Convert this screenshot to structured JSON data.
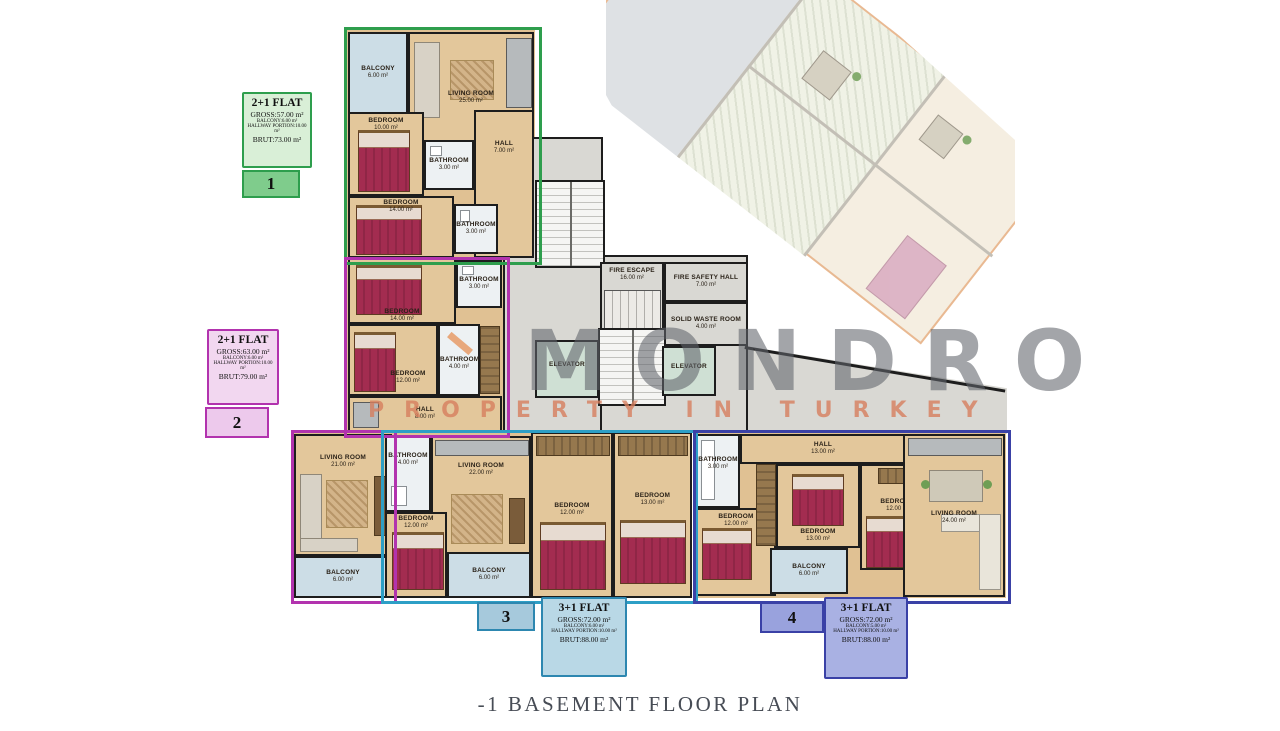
{
  "title": "-1 BASEMENT FLOOR PLAN",
  "watermark": {
    "line1": "MONDRO",
    "line2": "PROPERTY IN TURKEY"
  },
  "flats": [
    {
      "badge": "1",
      "name": "2+1 FLAT",
      "gross": "GROSS:57.00 m²",
      "balcony": "BALCONY:6.00 m²",
      "hallway": "HALLWAY PORTION:10.00 m²",
      "brut": "BRUT:73.00 m²",
      "color": "#2e9e4d"
    },
    {
      "badge": "2",
      "name": "2+1 FLAT",
      "gross": "GROSS:63.00 m²",
      "balcony": "BALCONY:6.00 m²",
      "hallway": "HALLWAY PORTION:10.00 m²",
      "brut": "BRUT:79.00 m²",
      "color": "#b233ae"
    },
    {
      "badge": "3",
      "name": "3+1 FLAT",
      "gross": "GROSS:72.00 m²",
      "balcony": "BALCONY:6.00 m²",
      "hallway": "HALLWAY PORTION:10.00 m²",
      "brut": "BRUT:88.00 m²",
      "color": "#2d87b0"
    },
    {
      "badge": "4",
      "name": "3+1 FLAT",
      "gross": "GROSS:72.00 m²",
      "balcony": "BALCONY:5.00 m²",
      "hallway": "HALLWAY PORTION:10.00 m²",
      "brut": "BRUT:88.00 m²",
      "color": "#3a41a6"
    }
  ],
  "rooms": [
    {
      "name": "BALCONY",
      "area": "6.00 m²"
    },
    {
      "name": "LIVING ROOM",
      "area": "25.00 m²"
    },
    {
      "name": "BEDROOM",
      "area": "10.00 m²"
    },
    {
      "name": "BATHROOM",
      "area": "3.00 m²"
    },
    {
      "name": "HALL",
      "area": "7.00 m²"
    },
    {
      "name": "BEDROOM",
      "area": "14.00 m²"
    },
    {
      "name": "BATHROOM",
      "area": "3.00 m²"
    },
    {
      "name": "BEDROOM",
      "area": "14.00 m²"
    },
    {
      "name": "BATHROOM",
      "area": "3.00 m²"
    },
    {
      "name": "BEDROOM",
      "area": "12.00 m²"
    },
    {
      "name": "BATHROOM",
      "area": "4.00 m²"
    },
    {
      "name": "HALL",
      "area": "8.00 m²"
    },
    {
      "name": "LIVING ROOM",
      "area": "21.00 m²"
    },
    {
      "name": "BALCONY",
      "area": "6.00 m²"
    },
    {
      "name": "BATHROOM",
      "area": "4.00 m²"
    },
    {
      "name": "LIVING ROOM",
      "area": "22.00 m²"
    },
    {
      "name": "BEDROOM",
      "area": "12.00 m²"
    },
    {
      "name": "BALCONY",
      "area": "6.00 m²"
    },
    {
      "name": "BEDROOM",
      "area": "12.00 m²"
    },
    {
      "name": "BEDROOM",
      "area": "13.00 m²"
    },
    {
      "name": "BATHROOM",
      "area": "3.00 m²"
    },
    {
      "name": "HALL",
      "area": "13.00 m²"
    },
    {
      "name": "BEDROOM",
      "area": "12.00 m²"
    },
    {
      "name": "BEDROOM",
      "area": "13.00 m²"
    },
    {
      "name": "BALCONY",
      "area": "6.00 m²"
    },
    {
      "name": "BEDROOM",
      "area": "12.00 m²"
    },
    {
      "name": "LIVING ROOM",
      "area": "24.00 m²"
    },
    {
      "name": "FIRE ESCAPE",
      "area": "16.00 m²"
    },
    {
      "name": "FIRE SAFETY HALL",
      "area": "7.00 m²"
    },
    {
      "name": "SOLID WASTE ROOM",
      "area": "4.00 m²"
    },
    {
      "name": "ELEVATOR",
      "area": ""
    },
    {
      "name": "ELEVATOR",
      "area": ""
    }
  ],
  "colors": {
    "wood_floor": "#e3c79b",
    "balcony": "#ccdde6",
    "concrete": "#d9d8d3",
    "bed": "#a32c50",
    "watermark_gray": "#60646a",
    "watermark_salmon": "#d67e5e",
    "ghost_outline": "#e09860"
  }
}
